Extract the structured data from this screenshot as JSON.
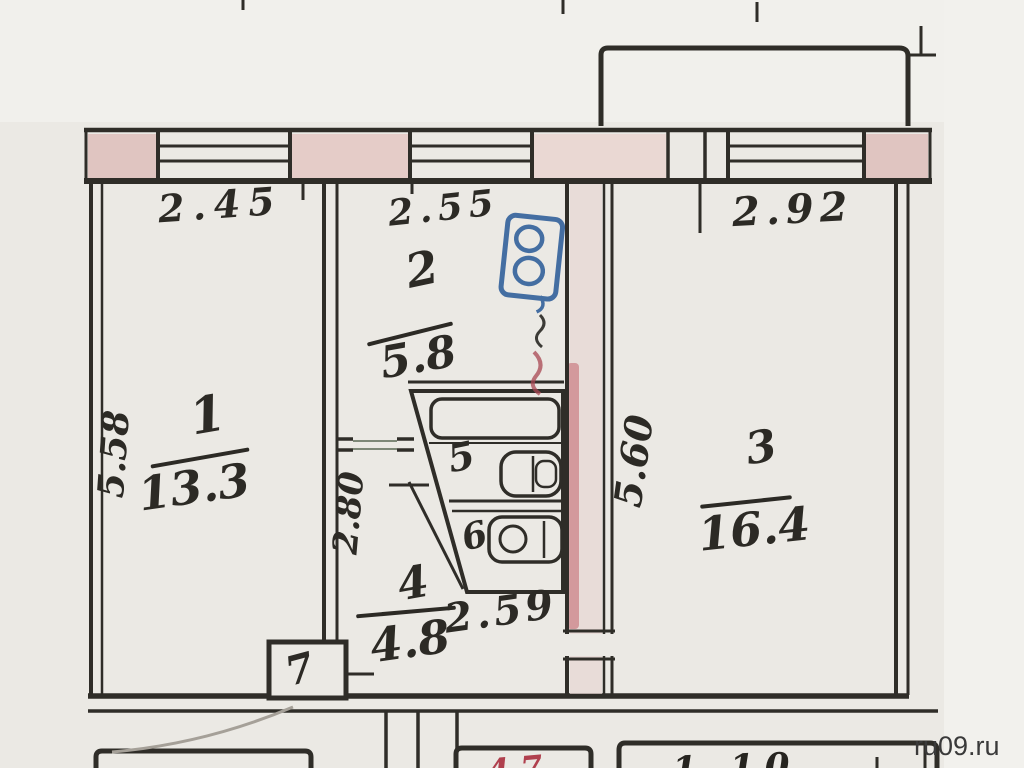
{
  "page": {
    "watermark": "ru09.ru"
  },
  "plan": {
    "rooms": [
      {
        "number": "1",
        "area": "13.3",
        "width": "2.45",
        "depth": "5.58"
      },
      {
        "number": "2",
        "area": "5.8",
        "width": "2.55"
      },
      {
        "number": "3",
        "area": "16.4",
        "width": "2.92",
        "depth": "5.60"
      },
      {
        "number": "4",
        "area": "4.8",
        "width": "2.59",
        "depth": "2.80"
      },
      {
        "number": "5"
      },
      {
        "number": "6"
      },
      {
        "number": "7"
      }
    ],
    "lower_floor_partial": {
      "red_label": "4.7",
      "dark_label": "1.10"
    },
    "colors": {
      "paper": "#ebe9e4",
      "ink": "#2f2d28",
      "pink_wall": "#e2c6c2",
      "stamp_blue": "#2e5e99",
      "mark_red": "#b0404e"
    }
  }
}
